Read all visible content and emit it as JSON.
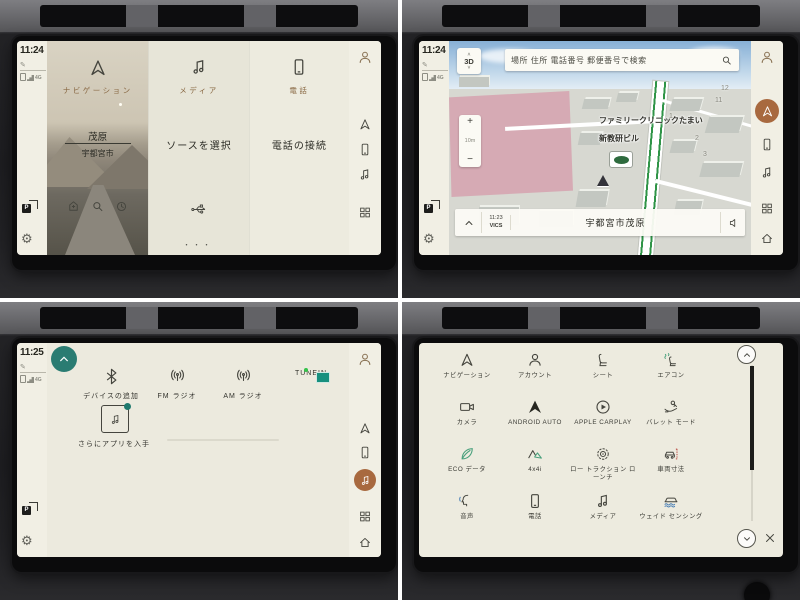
{
  "ui": {
    "projection_letter": "P",
    "colors": {
      "copper": "#a8693f",
      "teal": "#2a7c72",
      "home_label_brown": "#8a6a45",
      "tunein_bg": "#0e2d35",
      "map_green_road": "#2f9447",
      "map_pink": "#d6aab4"
    },
    "icons": [
      "navigation-arrow-icon",
      "person-icon",
      "phone-icon",
      "music-note-icon",
      "app-grid-icon",
      "home-icon",
      "settings-gear-icon",
      "screen-projection-icon",
      "search-icon",
      "recents-clock-icon",
      "poi-icon",
      "usb-icon",
      "bluetooth-icon",
      "radio-waves-icon",
      "chevron-up-icon",
      "chevron-down-icon",
      "speaker-icon",
      "close-icon",
      "compass-icon"
    ]
  },
  "q1": {
    "screen": "home",
    "time": "11:24",
    "status_network": "4G",
    "nav": {
      "label": "ナビゲーション",
      "dest": "茂原",
      "city": "宇都宮市"
    },
    "media": {
      "label": "メディア",
      "action": "ソースを選択"
    },
    "phone": {
      "label": "電話",
      "action": "電話の接続"
    },
    "dots": "・・・"
  },
  "q2": {
    "screen": "navigation-map",
    "time": "11:24",
    "status_network": "4G",
    "view_mode": "3D",
    "search_placeholder": "場所 住所 電話番号 郵便番号で検索",
    "zoom_in": "+",
    "zoom_out": "−",
    "scale": "10m",
    "poi1": "ファミリークリニックたまい",
    "poi2": "新教研ビル",
    "numbers": [
      "1",
      "2",
      "3",
      "11",
      "12"
    ],
    "vics_time": "11:23",
    "vics": "VICS",
    "location": "宇都宮市茂原"
  },
  "q3": {
    "screen": "media-sources",
    "time": "11:25",
    "status_network": "4G",
    "sources": [
      {
        "label": "デバイスの追加",
        "icon": "bluetooth-icon"
      },
      {
        "label": "FM ラジオ",
        "icon": "fm-radio-icon"
      },
      {
        "label": "AM ラジオ",
        "icon": "am-radio-icon"
      },
      {
        "label": "TUNEIN",
        "icon": "tunein-icon"
      }
    ],
    "more_apps": "さらにアプリを入手"
  },
  "q4": {
    "screen": "settings-apps",
    "apps": [
      {
        "label": "ナビゲーション",
        "icon": "navigation-icon"
      },
      {
        "label": "アカウント",
        "icon": "account-icon"
      },
      {
        "label": "シート",
        "icon": "seat-icon"
      },
      {
        "label": "エアコン",
        "icon": "climate-icon"
      },
      {
        "label": "カメラ",
        "icon": "camera-icon"
      },
      {
        "label": "ANDROID AUTO",
        "icon": "android-auto-icon"
      },
      {
        "label": "APPLE CARPLAY",
        "icon": "apple-carplay-icon"
      },
      {
        "label": "バレット モード",
        "icon": "valet-mode-icon"
      },
      {
        "label": "ECO データ",
        "icon": "eco-data-icon"
      },
      {
        "label": "4x4i",
        "icon": "4x4i-icon"
      },
      {
        "label": "ロー トラクション ローンチ",
        "icon": "low-traction-launch-icon"
      },
      {
        "label": "車両寸法",
        "icon": "vehicle-dimensions-icon"
      },
      {
        "label": "音声",
        "icon": "voice-icon"
      },
      {
        "label": "電話",
        "icon": "phone-icon"
      },
      {
        "label": "メディア",
        "icon": "media-icon"
      },
      {
        "label": "ウェイド センシング",
        "icon": "wade-sensing-icon"
      }
    ]
  }
}
